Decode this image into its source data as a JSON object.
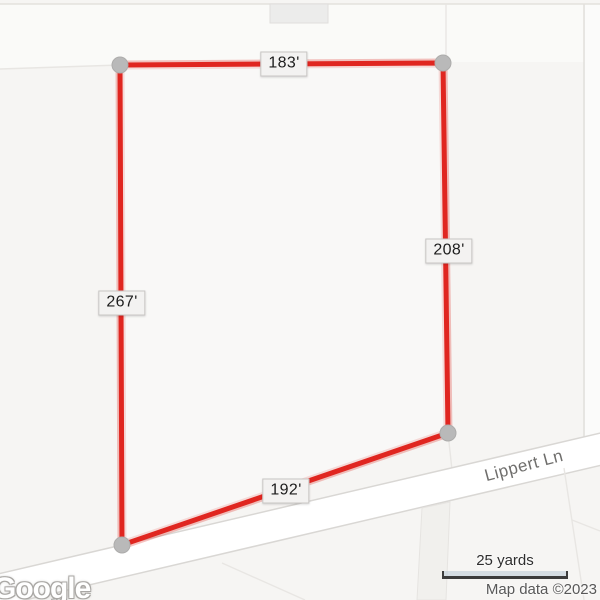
{
  "map": {
    "road_label": "Lippert Ln",
    "measurements": {
      "top": "183'",
      "right": "208'",
      "left": "267'",
      "bottom": "192'"
    },
    "scale": {
      "label": "25 yards"
    },
    "attribution": {
      "logo": "Google",
      "map_data": "Map data ©2023"
    },
    "colors": {
      "measure_line": "#e02620",
      "vertex_dot": "#b9b9b9",
      "map_bg": "#f6f5f3",
      "road_fill": "#ffffff",
      "parcel_line": "#e3e1dd",
      "label_bg": "#f3f2f1",
      "label_border": "#c8c6c4",
      "label_text": "#1d1d1d"
    }
  }
}
